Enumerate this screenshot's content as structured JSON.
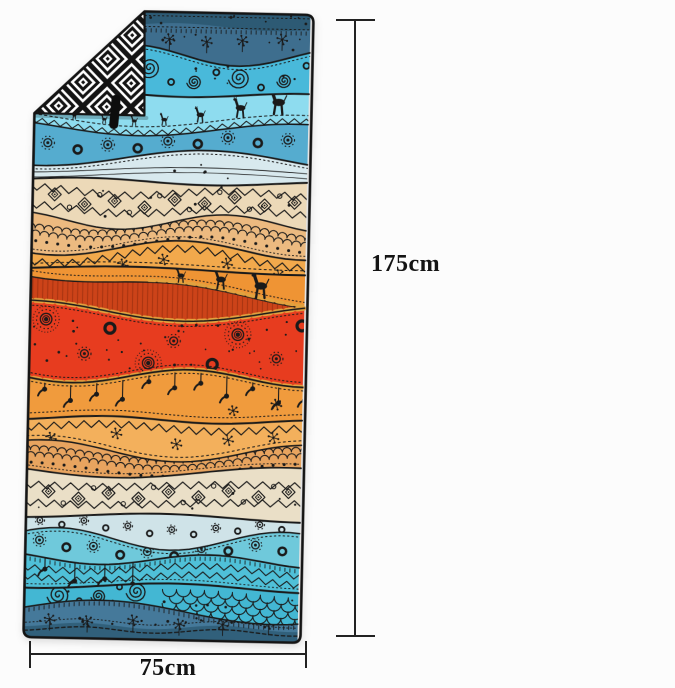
{
  "background": "#fcfcfc",
  "dimensions": {
    "height_label": "175cm",
    "width_label": "75cm",
    "line_color": "#222222",
    "label_color": "#141414"
  },
  "towel": {
    "outline": "#141414",
    "ink": "#1a1a1a",
    "accents": {
      "mustard": "#e2a23f",
      "stripe_red": "#cc4319",
      "stripe_dark": "#8e2a0e",
      "band_top_dark": "#2d5a74",
      "band_bottom_dark": "#31607b"
    },
    "fold": {
      "light": "#ffffff",
      "dark": "#141414",
      "tag": "#0d0d0d"
    },
    "bands": [
      {
        "h": 43,
        "color": "#3e6e8e",
        "motif": "stars-dots"
      },
      {
        "h": 39,
        "color": "#49b9da",
        "motif": "spirals"
      },
      {
        "h": 35,
        "color": "#8edcef",
        "motif": "giraffes"
      },
      {
        "h": 30,
        "color": "#55accf",
        "motif": "suns-row"
      },
      {
        "h": 23,
        "color": "#d8e9ee",
        "motif": "plain"
      },
      {
        "h": 40,
        "color": "#ecd9b8",
        "motif": "diamonds"
      },
      {
        "h": 27,
        "color": "#ecba80",
        "motif": "braid"
      },
      {
        "h": 21,
        "color": "#f2a94c",
        "motif": "zigzag-stars"
      },
      {
        "h": 42,
        "color": "#ef9434",
        "motif": "wave-giraffes"
      },
      {
        "h": 65,
        "color": "#e73c1f",
        "motif": "suns-big"
      },
      {
        "h": 43,
        "color": "#f09b3d",
        "motif": "birds"
      },
      {
        "h": 32,
        "color": "#f3b05c",
        "motif": "zigzag-stars"
      },
      {
        "h": 20,
        "color": "#e8a45f",
        "motif": "braid"
      },
      {
        "h": 45,
        "color": "#eadfc7",
        "motif": "diamonds"
      },
      {
        "h": 23,
        "color": "#cfe3e8",
        "motif": "suns-row"
      },
      {
        "h": 20,
        "color": "#6fc9db",
        "motif": "suns-row"
      },
      {
        "h": 27,
        "color": "#4fc0d8",
        "motif": "zigzag-birds"
      },
      {
        "h": 25,
        "color": "#43b7d3",
        "motif": "spirals-scales"
      },
      {
        "h": 28,
        "color": "#45799a",
        "motif": "stars-stitch"
      }
    ]
  }
}
